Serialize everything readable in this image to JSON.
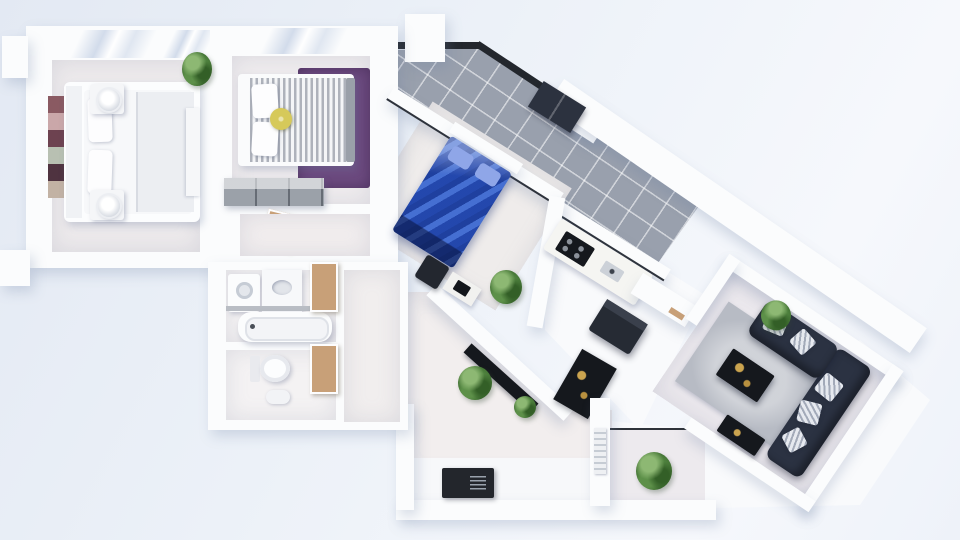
{
  "scene": {
    "type": "3d-floor-plan-top-down-render",
    "description": "Top view 3D render of an apartment: two bedrooms and bathroom in the left wing, a diagonal wing with a third bedroom, kitchen and tiled terrace, hallway with entrance doormat, and a living room with corner sofa on the right.",
    "palette": {
      "wall": "#fbfcfd",
      "floor": "#efecee",
      "tile_gray": "#99a0ad",
      "railing_black": "#23272d",
      "wood_door": "#c8a078",
      "purple_rug": "#6d4b80",
      "blue_duvet": "#2a55c4",
      "navy_sofa": "#2b3242",
      "navy_wardrobe": "#2c323f",
      "dark_furniture": "#15181d",
      "appliance_dark": "#262b34",
      "dresser_gray": "#9ba1a9",
      "area_rug_gray": "#b7bbc4",
      "gold_decor": "#cba44f",
      "yellow_cushion": "#d6c95a",
      "plant_green": "#4d7f3e",
      "doormat": "#23262c",
      "bench_gray": "#9aa0a9",
      "sink_gray": "#ccd1d8"
    },
    "art_colors": [
      "#8a5a62",
      "#caa7a9",
      "#6d4250",
      "#b8c0b2",
      "#4f3340",
      "#c2b2a4"
    ],
    "rooms": [
      {
        "id": "bedroom-main",
        "label": "Bedroom 1",
        "furniture": [
          "double bed",
          "headboard",
          "2 pillows",
          "2 nightstands",
          "2 round lamps",
          "wall art collage",
          "wardrobe",
          "potted plant"
        ]
      },
      {
        "id": "bedroom-second",
        "label": "Bedroom 2",
        "furniture": [
          "striped bed",
          "2 pillows",
          "round yellow cushion",
          "purple rug",
          "gray dresser",
          "foot bench"
        ]
      },
      {
        "id": "bathroom",
        "label": "Bathroom",
        "furniture": [
          "washing machine",
          "vanity sink",
          "bathtub",
          "toilet",
          "bidet",
          "2 wooden doors"
        ]
      },
      {
        "id": "bedroom-blue",
        "label": "Bedroom 3",
        "furniture": [
          "blue double bed",
          "dark ottoman",
          "desk with laptop",
          "potted plant",
          "navy wardrobe"
        ]
      },
      {
        "id": "kitchen",
        "label": "Kitchen",
        "furniture": [
          "counter",
          "dark cooktop",
          "sink",
          "dark island fridge",
          "dark rug with gold statue"
        ]
      },
      {
        "id": "terrace",
        "label": "Tiled terrace",
        "furniture": [
          "gray diagonal floor tiles",
          "black railing",
          "chimney block"
        ]
      },
      {
        "id": "hallway",
        "label": "Hallway / entry",
        "furniture": [
          "entrance doormat",
          "diagonal sideboard",
          "2 potted plants",
          "radiator"
        ]
      },
      {
        "id": "living-room",
        "label": "Living room",
        "furniture": [
          "navy corner sofa",
          "5 cushions",
          "gray area rug",
          "coffee table with gold decor",
          "side table",
          "2 potted plants"
        ]
      }
    ],
    "orientation": {
      "left_wing_deg": 0,
      "middle_wing_deg": 32,
      "living_room_deg": 34
    }
  }
}
